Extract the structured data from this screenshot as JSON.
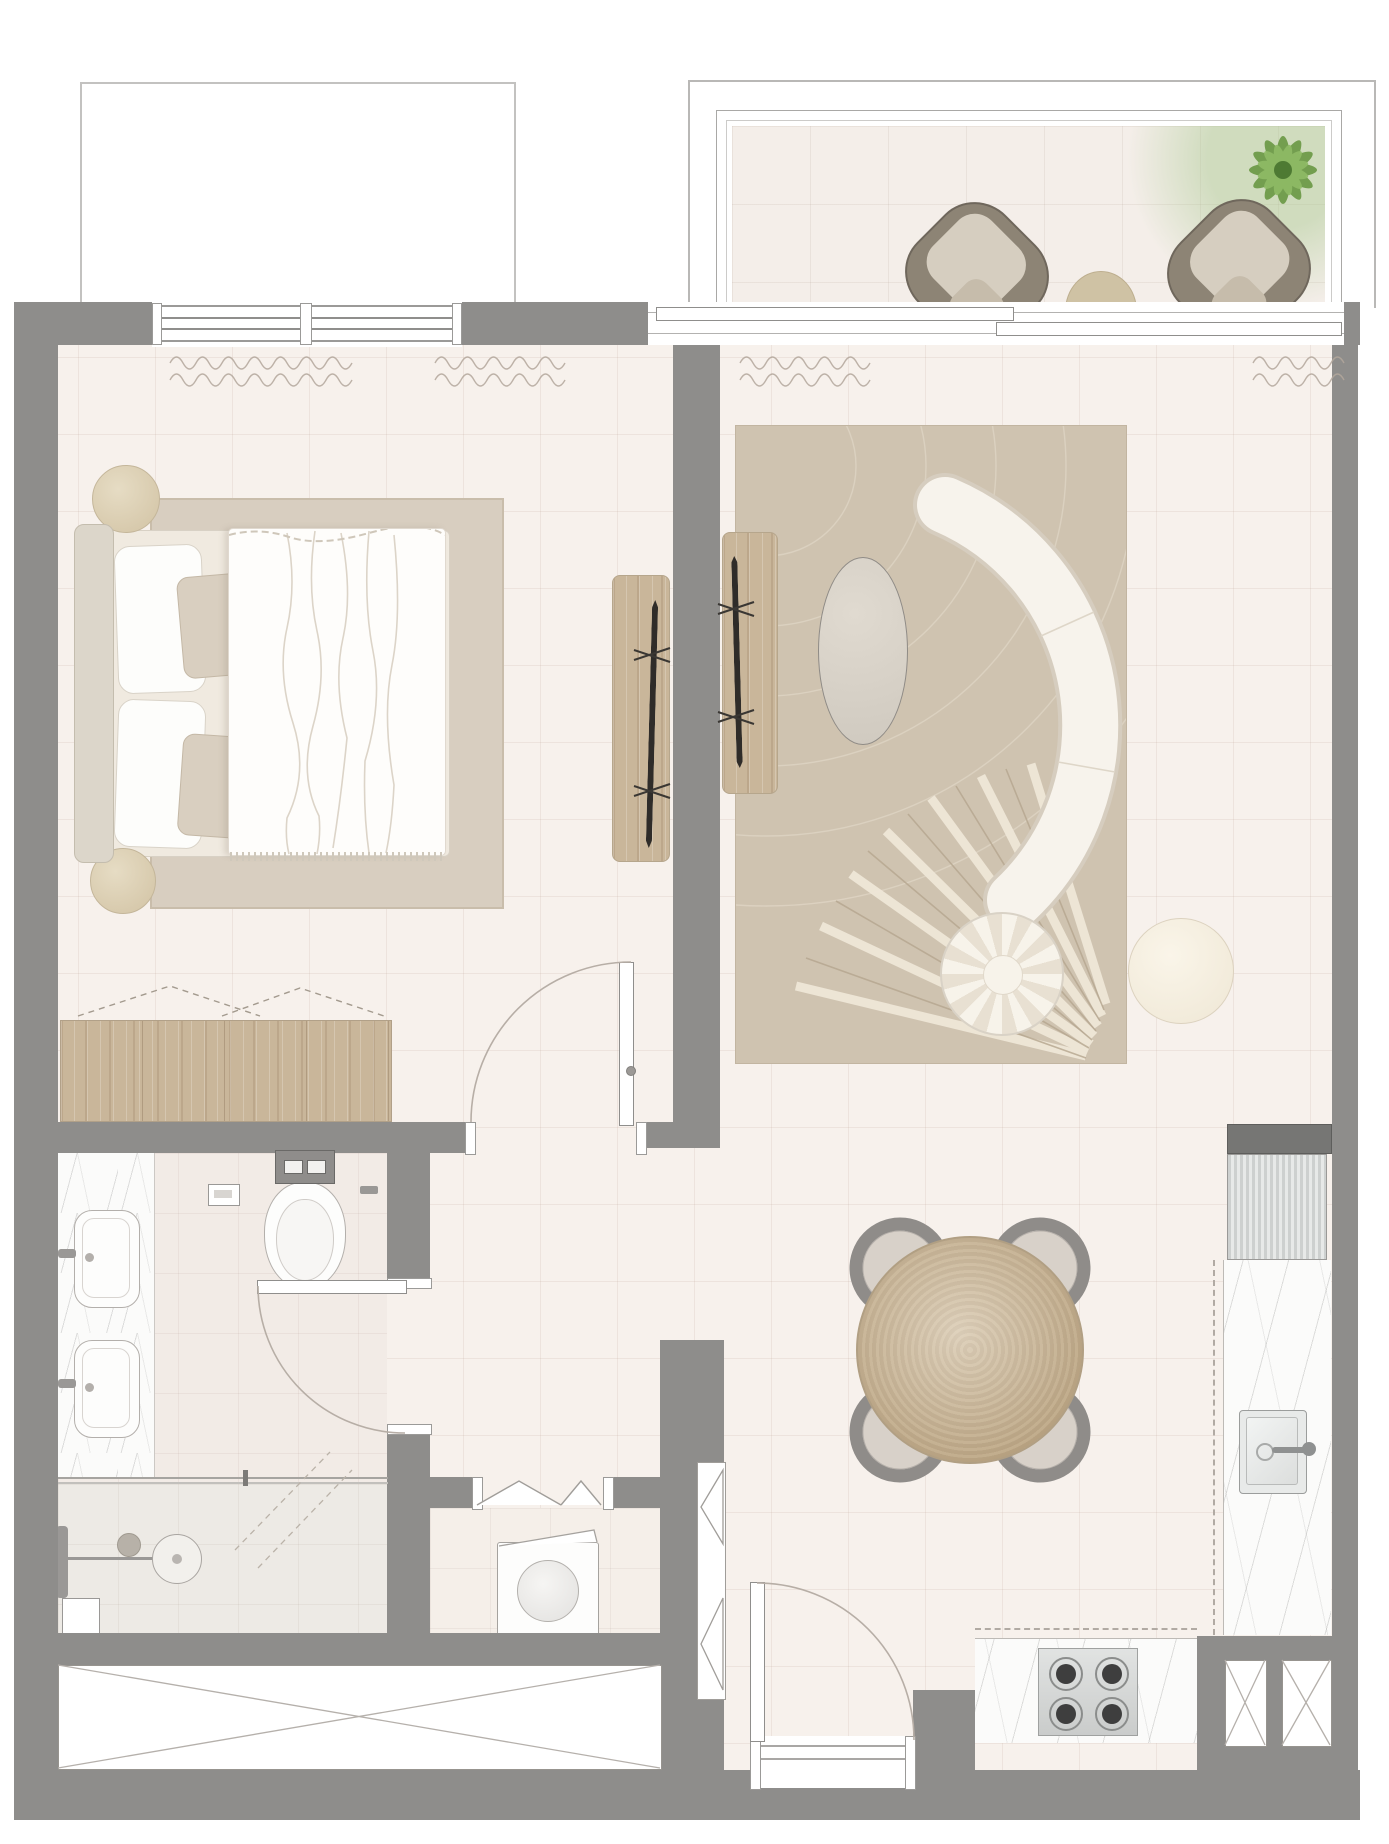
{
  "meta": {
    "kind": "architectural floor plan (top view, 1-bedroom apartment)",
    "canvas": {
      "width": 1389,
      "height": 1844
    },
    "visible_text": "none"
  },
  "palette": {
    "wall": "#8e8d8b",
    "wallDark": "#767674",
    "floor": "#f7f1ec",
    "bathFloor": "#f2ebe6",
    "showerFloor": "#edeae5",
    "laundryFloor": "#f5efe9",
    "balconyFloor": "#f4eee9",
    "marble": "#fbfbfa",
    "wood": "#c9b69a",
    "rugBed": "#d8cec0",
    "rugLiving": "#cfc3b0",
    "cream": "#f6f2ea",
    "creamBorder": "#d8d0c2",
    "beige": "#dbcfb6",
    "lineGray": "#9c9a97",
    "doorArc": "#b7aea6",
    "chairGray": "#8f8c89",
    "chairSeat": "#d8d1c9",
    "steel": "#d7d9d8",
    "burner": "#3e3e3e",
    "white": "#ffffff",
    "outline": "#c3c2c0"
  },
  "rooms": {
    "bedroom": {
      "name": "Bedroom"
    },
    "living": {
      "name": "Living room"
    },
    "dining": {
      "name": "Dining area"
    },
    "kitchen": {
      "name": "Kitchen"
    },
    "bathroom": {
      "name": "Bathroom"
    },
    "shower": {
      "name": "Walk-in shower"
    },
    "laundry": {
      "name": "Laundry closet"
    },
    "hallway": {
      "name": "Hallway"
    },
    "entry": {
      "name": "Entry vestibule"
    },
    "closet": {
      "name": "Built-in closet"
    },
    "balcony": {
      "name": "Balcony"
    },
    "terrace": {
      "name": "Adjacent terrace outline"
    }
  },
  "furniture": {
    "bed": {
      "label": "Double bed with headboard and 4 pillows"
    },
    "duvet": {
      "label": "White duvet"
    },
    "stool1": {
      "label": "Round bedside stool"
    },
    "stool2": {
      "label": "Round bedside stool"
    },
    "bedroomRug": {
      "label": "Bedroom area rug"
    },
    "wardrobe": {
      "label": "Built-in wardrobe dresser"
    },
    "bedroomTv": {
      "label": "Bedroom TV media panel"
    },
    "livingTv": {
      "label": "Living room TV media panel"
    },
    "livingRug": {
      "label": "Patterned living room rug"
    },
    "sofa": {
      "label": "Curved crescent sofa"
    },
    "coffeeTable": {
      "label": "Oval coffee table"
    },
    "pouf": {
      "label": "Round tufted pouf"
    },
    "sideTable": {
      "label": "Round side table"
    },
    "diningTable": {
      "label": "Round wooden dining table"
    },
    "diningChairs": {
      "label": "4 dining chairs"
    },
    "tallCabinet": {
      "label": "Tall kitchen cabinet"
    },
    "fridge": {
      "label": "Refrigerator"
    },
    "kitchenSink": {
      "label": "Kitchen sink with faucet"
    },
    "hob": {
      "label": "4-burner hob"
    },
    "worktopRight": {
      "label": "Marble worktop (sink run)"
    },
    "worktopBottom": {
      "label": "Marble worktop (hob run)"
    },
    "shaft1": {
      "label": "Service shaft"
    },
    "shaft2": {
      "label": "Service shaft"
    },
    "vanity": {
      "label": "Double vanity with two basins"
    },
    "toilet": {
      "label": "Wall-hung toilet"
    },
    "flushPlate": {
      "label": "Flush plate"
    },
    "tpHolder": {
      "label": "Toilet paper holder"
    },
    "showerSet": {
      "label": "Shower head set"
    },
    "glassScreen": {
      "label": "Glass shower screen"
    },
    "washer": {
      "label": "Washing machine"
    },
    "bifoldDoors": {
      "label": "Bi-fold laundry doors"
    },
    "hallCabinet": {
      "label": "Tall hallway cabinet"
    },
    "storageX": {
      "label": "Built-in storage (cross symbol)"
    },
    "entryDoor": {
      "label": "Entrance door"
    },
    "bedroomDoor": {
      "label": "Bedroom door"
    },
    "bathroomDoor": {
      "label": "Bathroom door"
    },
    "bedroomWindow": {
      "label": "Bedroom window"
    },
    "sliderDoor": {
      "label": "Sliding balcony door"
    },
    "curtains": {
      "label": "Curtains (wavy symbol)"
    },
    "loungeChair1": {
      "label": "Balcony lounge chair"
    },
    "loungeChair2": {
      "label": "Balcony lounge chair"
    },
    "balconyTable": {
      "label": "Balcony round table"
    },
    "plant": {
      "label": "Potted plant"
    },
    "railing": {
      "label": "Balcony railing"
    }
  }
}
